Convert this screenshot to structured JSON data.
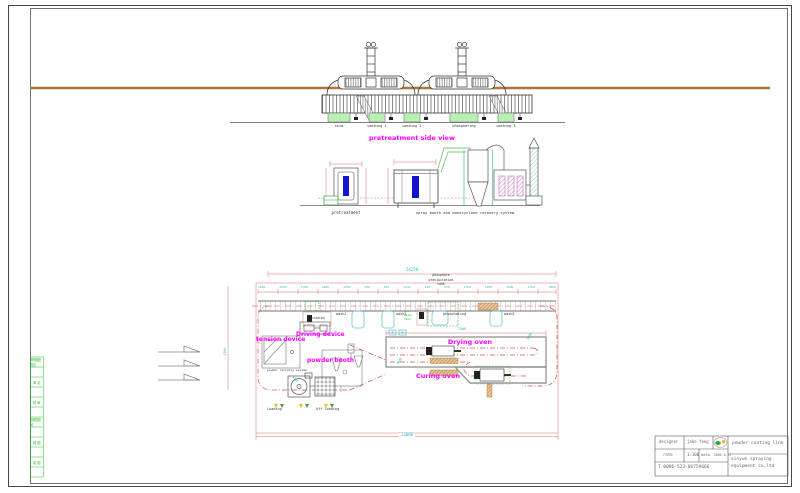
{
  "colors": {
    "magenta_label": "#ff00ff",
    "cyan_dimension": "#2fb8c8",
    "red_dimension": "#e07070",
    "tank_green": "#b9f0b4",
    "workpiece_blue": "#1515cc",
    "brown_rail": "#a8763e",
    "burner_brown": "#b97a2a",
    "strip_green": "#2eb82e"
  },
  "side_view": {
    "title": "pretreatment side view",
    "tanks": [
      "skim",
      "washing 1",
      "washing 2",
      "phosphating",
      "washing 3"
    ]
  },
  "equipment": {
    "pretreatment_label": "pretreatment",
    "spray_label": "spray booth and monocyclone recovery system"
  },
  "plan": {
    "total_dim": "24250",
    "bottom_dim": "23000",
    "oven_dim": "7500",
    "side_dim": "1500",
    "radius_dims": [
      "3000",
      "3000",
      "3000"
    ],
    "dims": [
      "1500",
      "2000",
      "1700",
      "2000",
      "1450",
      "500",
      "950",
      "1443",
      "448",
      "950",
      "1700",
      "1200",
      "1500",
      "1750",
      "2000"
    ],
    "phosphate_note": [
      "phosphate",
      "precipitation",
      "tank"
    ],
    "fluid_note": [
      "hot",
      "water",
      "tank"
    ],
    "stations": {
      "skim": "skim",
      "wash1": "wash1",
      "wash2": "wash2",
      "phosphating": "phosphating",
      "wash3": "wash3"
    },
    "labels": {
      "driving": "Driving device",
      "tension": "tension device",
      "powder_booth": "powder booth",
      "recovery": "powder recovery system",
      "drying": "Drying oven",
      "curing": "Curing oven",
      "loading": "Loading",
      "offloading": "Off-loading"
    }
  },
  "title_block": {
    "designer_label": "designer",
    "designer_name": "jake feng",
    "rate_label": "rate",
    "rate_value": "1:100",
    "date_label": "date",
    "date_value": "2005.6.17",
    "phone": "T:0086-523-86759666",
    "project": "powder coating line",
    "company_line1": "xinyue spraying",
    "company_line2": "equipment co,ltd"
  },
  "left_strip": {
    "rows": [
      "修改图纸签记",
      "审 定",
      "校 审",
      "旧底图总号",
      "描 图",
      "制 图"
    ]
  }
}
